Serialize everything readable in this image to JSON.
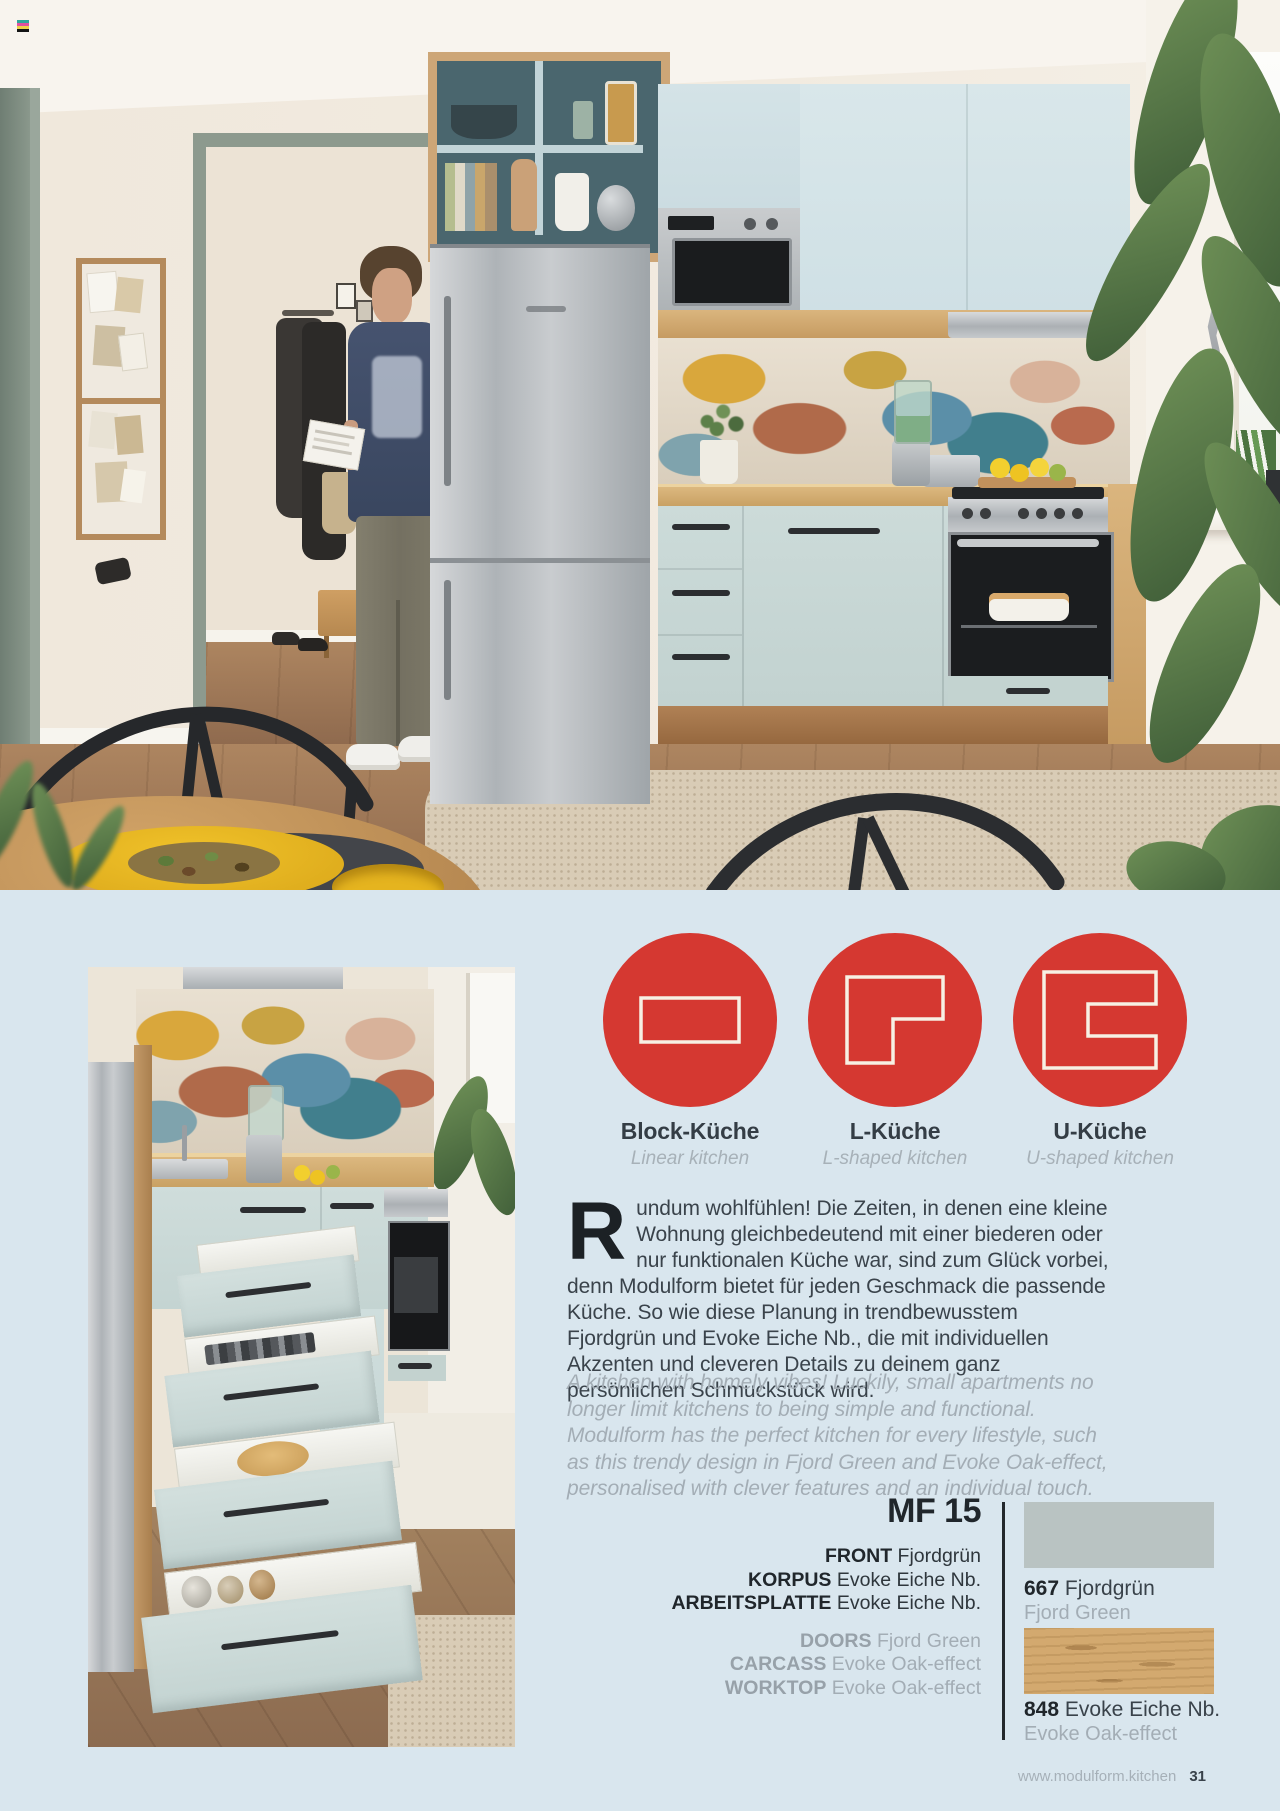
{
  "page": {
    "background": "#d9e6ee",
    "footer_url": "www.modulform.kitchen",
    "page_number": "31"
  },
  "colors": {
    "accent_red": "#d53831",
    "icon_outline": "#f7f0e4",
    "text_dark": "#39424a",
    "text_gray": "#a3adb5"
  },
  "kitchen_types": [
    {
      "label": "Block-Küche",
      "sublabel": "Linear kitchen"
    },
    {
      "label": "L-Küche",
      "sublabel": "L-shaped kitchen"
    },
    {
      "label": "U-Küche",
      "sublabel": "U-shaped kitchen"
    }
  ],
  "intro_de": {
    "dropcap": "R",
    "text": "undum wohlfühlen! Die Zeiten, in denen eine kleine Wohnung gleichbedeutend mit einer biederen oder nur funktionalen Küche war, sind zum Glück vorbei, denn Modulform bietet für jeden Geschmack die passende Küche. So wie diese Planung in trendbewusstem Fjordgrün und Evoke Eiche Nb., die mit individuellen Akzenten und cleveren Details zu deinem ganz persönlichen Schmuckstück wird."
  },
  "intro_en": "A kitchen with homely vibes! Luckily, small apartments no longer limit kitchens to being simple and functional. Modulform has the perfect kitchen for every lifestyle, such as this trendy design in Fjord Green and Evoke Oak-effect, personalised with clever features and an individual touch.",
  "product": {
    "code": "MF 15",
    "specs_de": [
      {
        "label": "FRONT",
        "value": "Fjordgrün"
      },
      {
        "label": "KORPUS",
        "value": "Evoke Eiche Nb."
      },
      {
        "label": "ARBEITSPLATTE",
        "value": "Evoke Eiche Nb."
      }
    ],
    "specs_en": [
      {
        "label": "DOORS",
        "value": "Fjord Green"
      },
      {
        "label": "CARCASS",
        "value": "Evoke Oak-effect"
      },
      {
        "label": "WORKTOP",
        "value": "Evoke Oak-effect"
      }
    ]
  },
  "materials": [
    {
      "code": "667",
      "name_de": "Fjordgrün",
      "name_en": "Fjord Green",
      "swatch": "#b9c3c2"
    },
    {
      "code": "848",
      "name_de": "Evoke Eiche Nb.",
      "name_en": "Evoke Oak-effect",
      "swatch": "#d3a96f"
    }
  ]
}
